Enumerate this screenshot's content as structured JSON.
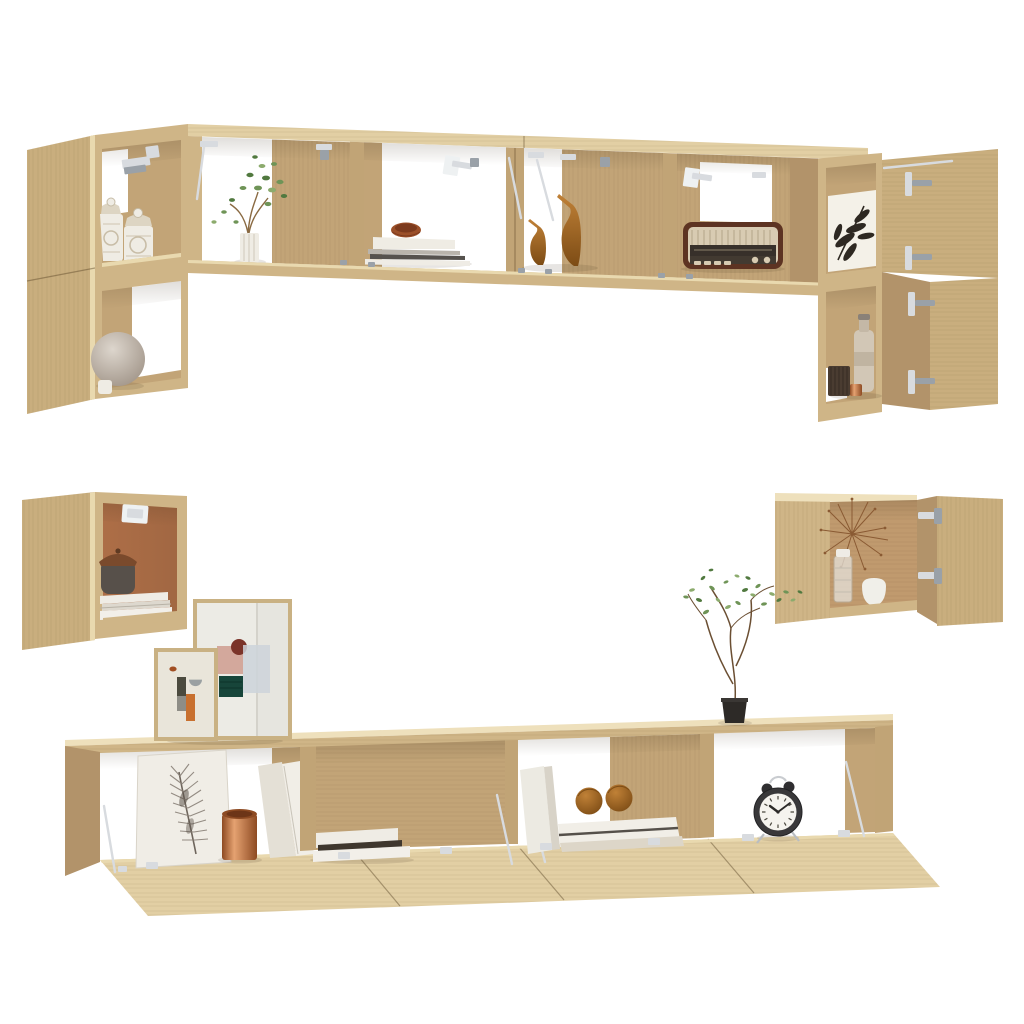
{
  "scene": {
    "background": "#ffffff",
    "style": "studio product photo, no text",
    "subject": "6-piece wall-mounted TV cabinet set with open doors and decor",
    "wood_finish": "sonoma-oak"
  },
  "palette": {
    "background": "#ffffff",
    "wood_top": "#e2cfa4",
    "wood_top_hi": "#eee0bc",
    "wood_front": "#cfb587",
    "wood_front_dark": "#c1a476",
    "wood_door": "#c9ae7e",
    "wood_side": "#b2936a",
    "wood_interior": "#c2a477",
    "wood_edge_hi": "#e9d9af",
    "terracotta": "#ad6e47",
    "metal": "#d8dbdf",
    "metal_dark": "#9aa1a8",
    "white_item": "#efece4",
    "copper_hi": "#e5a271",
    "copper_lo": "#8d4a22",
    "amber": "#b07a33",
    "duck_hi": "#c08137",
    "duck_lo": "#7d4c15",
    "leaf_dark": "#2e2922",
    "green_1": "#6f9457",
    "green_2": "#51793f",
    "green_3": "#8cab6d",
    "clock_body": "#39383a",
    "clock_face": "#f5f3ee",
    "art_pink": "#d3a89c",
    "art_rust": "#7b342a",
    "art_bluegray": "#ccd4da",
    "art_teal": "#17453a",
    "art_orange": "#c8702f",
    "art_olive": "#4b4a3e",
    "sphere_hi": "#ddd6cd",
    "sphere_lo": "#a2968a",
    "basket": "#57504a",
    "basket_lid": "#7a4a2c"
  },
  "furniture": {
    "set_name": "wall-mounted tv cabinet set, sonoma oak, 6 pieces",
    "pieces": [
      {
        "id": "top-left-tall-cabinet",
        "compartments": 2,
        "doors_open": 1,
        "items": [
          "carved-jar",
          "carved-jar",
          "sphere-lamp",
          "small-cup"
        ]
      },
      {
        "id": "top-wall-shelf",
        "compartments": 4,
        "items": [
          "plant-in-ribbed-vase",
          "book-stack-with-clay-bowl",
          "duck-figurine-small",
          "duck-figurine-large",
          "vintage-radio"
        ]
      },
      {
        "id": "top-right-tall-cabinet",
        "compartments": 2,
        "doors_open": 2,
        "items": [
          "botanical-leaf-print",
          "beige-bottle",
          "ribbed-canister",
          "copper-cup"
        ]
      },
      {
        "id": "mid-left-wall-box",
        "compartments": 1,
        "doors_open": 1,
        "items": [
          "lidded-basket",
          "paper-stack"
        ]
      },
      {
        "id": "mid-right-wall-box",
        "compartments": 1,
        "doors_open": 1,
        "items": [
          "dandelion-decor",
          "glass-jar",
          "white-pot"
        ]
      },
      {
        "id": "bottom-tv-stand",
        "compartments": 4,
        "flap_doors_open": 4,
        "items": [
          "feather-print",
          "copper-planter",
          "white-binders",
          "book-stack",
          "leaning-boards",
          "wooden-spheres",
          "alarm-clock"
        ]
      }
    ],
    "freestanding_decor": [
      "framed-abstract-art-large",
      "framed-abstract-art-small",
      "twig-plant-in-black-pot"
    ]
  },
  "clock": {
    "time": "10:09"
  }
}
